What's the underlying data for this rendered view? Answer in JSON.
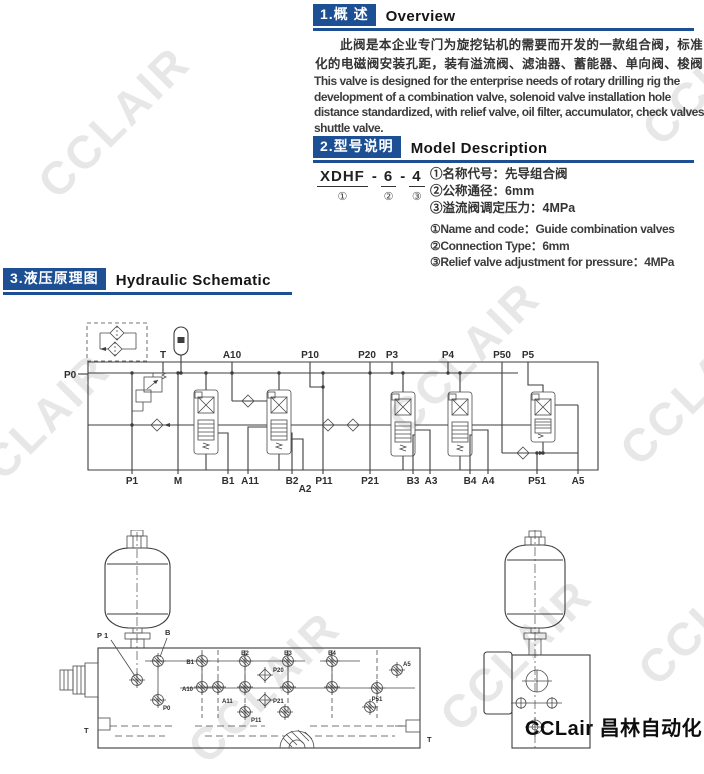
{
  "watermark": {
    "text": "CCLAIR",
    "color": "#e7e7e7"
  },
  "brand": {
    "logo": "CCLair 昌林自动化"
  },
  "colors": {
    "accent_blue": "#1c4f93",
    "line": "#3d3d3d",
    "text": "#333333"
  },
  "sections": {
    "overview": {
      "number_label": "1.概 述",
      "title": "Overview",
      "body_cn": "此阀是本企业专门为旋挖钻机的需要而开发的一款组合阀，标准化的电磁阀安装孔距，装有溢流阀、滤油器、蓄能器、单向阀、梭阀等。",
      "body_en": "This valve is designed for the enterprise needs of rotary drilling rig the development of a combination valve, solenoid valve installation hole distance standardized, with relief valve, oil filter, accumulator, check valves, shuttle valve."
    },
    "model": {
      "number_label": "2.型号说明",
      "title": "Model Description",
      "code": {
        "prefix": "XDHF",
        "dash1": "-",
        "size": "6",
        "dash2": "-",
        "pressure": "4",
        "mark1": "①",
        "mark2": "②",
        "mark3": "③"
      },
      "notes_cn": [
        "①名称代号：先导组合阀",
        "②公称通径：6mm",
        "③溢流阀调定压力：4MPa"
      ],
      "notes_en": [
        "①Name and code：Guide combination valves",
        "②Connection Type：6mm",
        "③Relief valve adjustment for pressure：4MPa"
      ]
    },
    "schematic": {
      "number_label": "3.液压原理图",
      "title": "Hydraulic Schematic",
      "port_left": "P0",
      "ports_top": [
        "T",
        "A10",
        "P10",
        "P20",
        "P3",
        "P4",
        "P50",
        "P5"
      ],
      "ports_bottom": [
        "P1",
        "M",
        "B1",
        "A11",
        "B2",
        "A2",
        "P11",
        "P21",
        "B3",
        "A3",
        "B4",
        "A4",
        "P51",
        "A5"
      ]
    },
    "drawings": {
      "front_labels": [
        "P 1",
        "B",
        "B1",
        "A10",
        "A11",
        "P0",
        "B2",
        "P11",
        "P20",
        "P21",
        "B3",
        "B4",
        "P51",
        "A5",
        "T",
        "T"
      ]
    }
  }
}
